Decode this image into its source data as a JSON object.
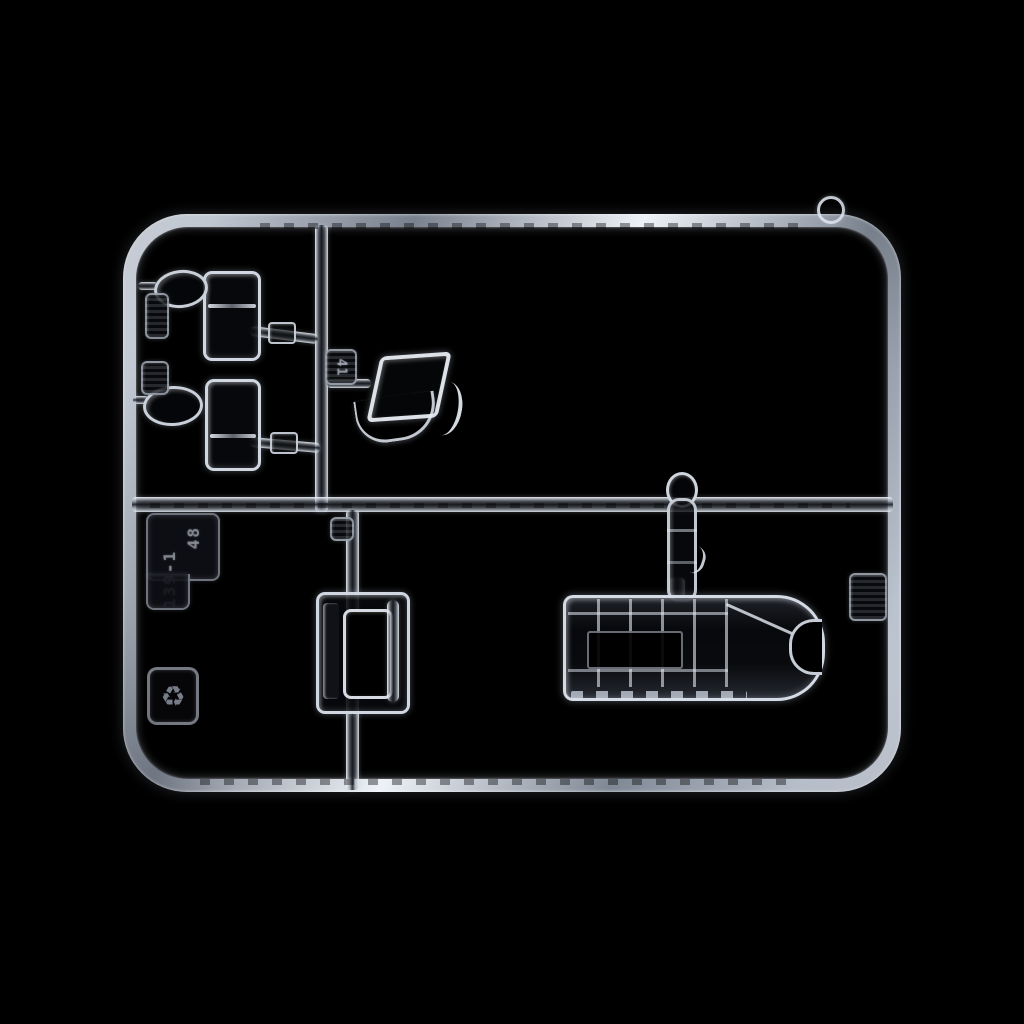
{
  "scene": {
    "description": "Photograph of a clear transparent injection-molded model-kit parts sprue (runner) on a black background",
    "object": "clear plastic sprue with aircraft canopy and window parts",
    "background": "#000000"
  },
  "markings": {
    "part_number_tag": "41",
    "plate_line_primary": "139-1",
    "plate_line_secondary": "48",
    "recycle_symbol": "♻",
    "tag_upper_left": "",
    "tag_lower_left": "",
    "tag_mid_runner": "",
    "tag_right_frame": ""
  },
  "colors": {
    "background": "#000000",
    "plastic_highlight": "#e9eef6",
    "plastic_mid": "#98a1ae",
    "plastic_shadow": "#15171d"
  },
  "parts": [
    {
      "name": "canopy-side-window-upper"
    },
    {
      "name": "canopy-side-window-lower"
    },
    {
      "name": "small-lens-upper"
    },
    {
      "name": "small-lens-lower"
    },
    {
      "name": "windscreen"
    },
    {
      "name": "teardrop-sight"
    },
    {
      "name": "sliding-canopy-section"
    },
    {
      "name": "greenhouse-canopy"
    }
  ]
}
